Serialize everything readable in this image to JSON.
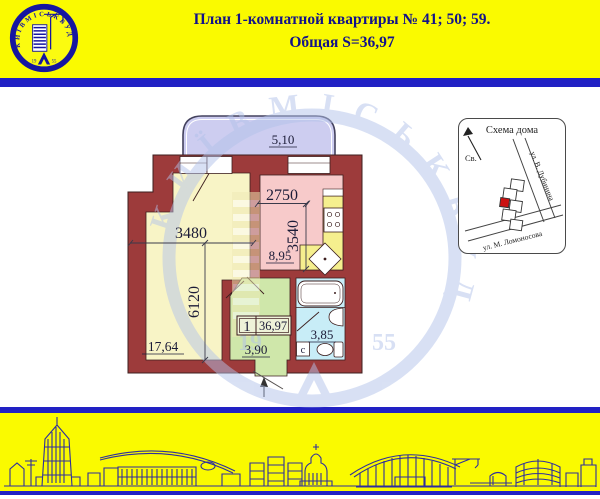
{
  "header": {
    "line1": "План 1-комнатной квартиры № 41; 50; 59.",
    "line2": "Общая S=36,97",
    "bg_color": "#fafa00",
    "text_color": "#12128a",
    "bar_color": "#2121c4"
  },
  "logo": {
    "brand": "КИЇВМІСЬКБУД",
    "year_left": "19",
    "year_right": "55"
  },
  "watermark": {
    "brand": "КИЇВМІСЬКБУД",
    "year_left": "19",
    "year_right": "55",
    "color": "#b3c3ea"
  },
  "plan": {
    "balcony": {
      "area": "5,10"
    },
    "living": {
      "width_mm": "3480",
      "height_mm": "6120",
      "area": "17,64"
    },
    "kitchen": {
      "width_mm": "2750",
      "height_mm": "3540",
      "area": "8,95"
    },
    "hall": {
      "area": "3,90"
    },
    "bath": {
      "area": "3,85",
      "washer_label": "с"
    },
    "summary": {
      "rooms": "1",
      "total_area": "36,97"
    },
    "colors": {
      "wall": "#9d3b3b",
      "living": "#f8f4c6",
      "kitchen": "#f7caca",
      "counter": "#f5ef8e",
      "hall": "#cfe7aa",
      "bath": "#c8edf7",
      "balcony": "#cdcdf0"
    }
  },
  "scheme": {
    "title": "Схема дома",
    "north_label": "Св.",
    "street_diagonal": "ул. В. Дубинина",
    "street_bottom": "ул. М. Ломоносова",
    "highlight_color": "#cc1111"
  }
}
